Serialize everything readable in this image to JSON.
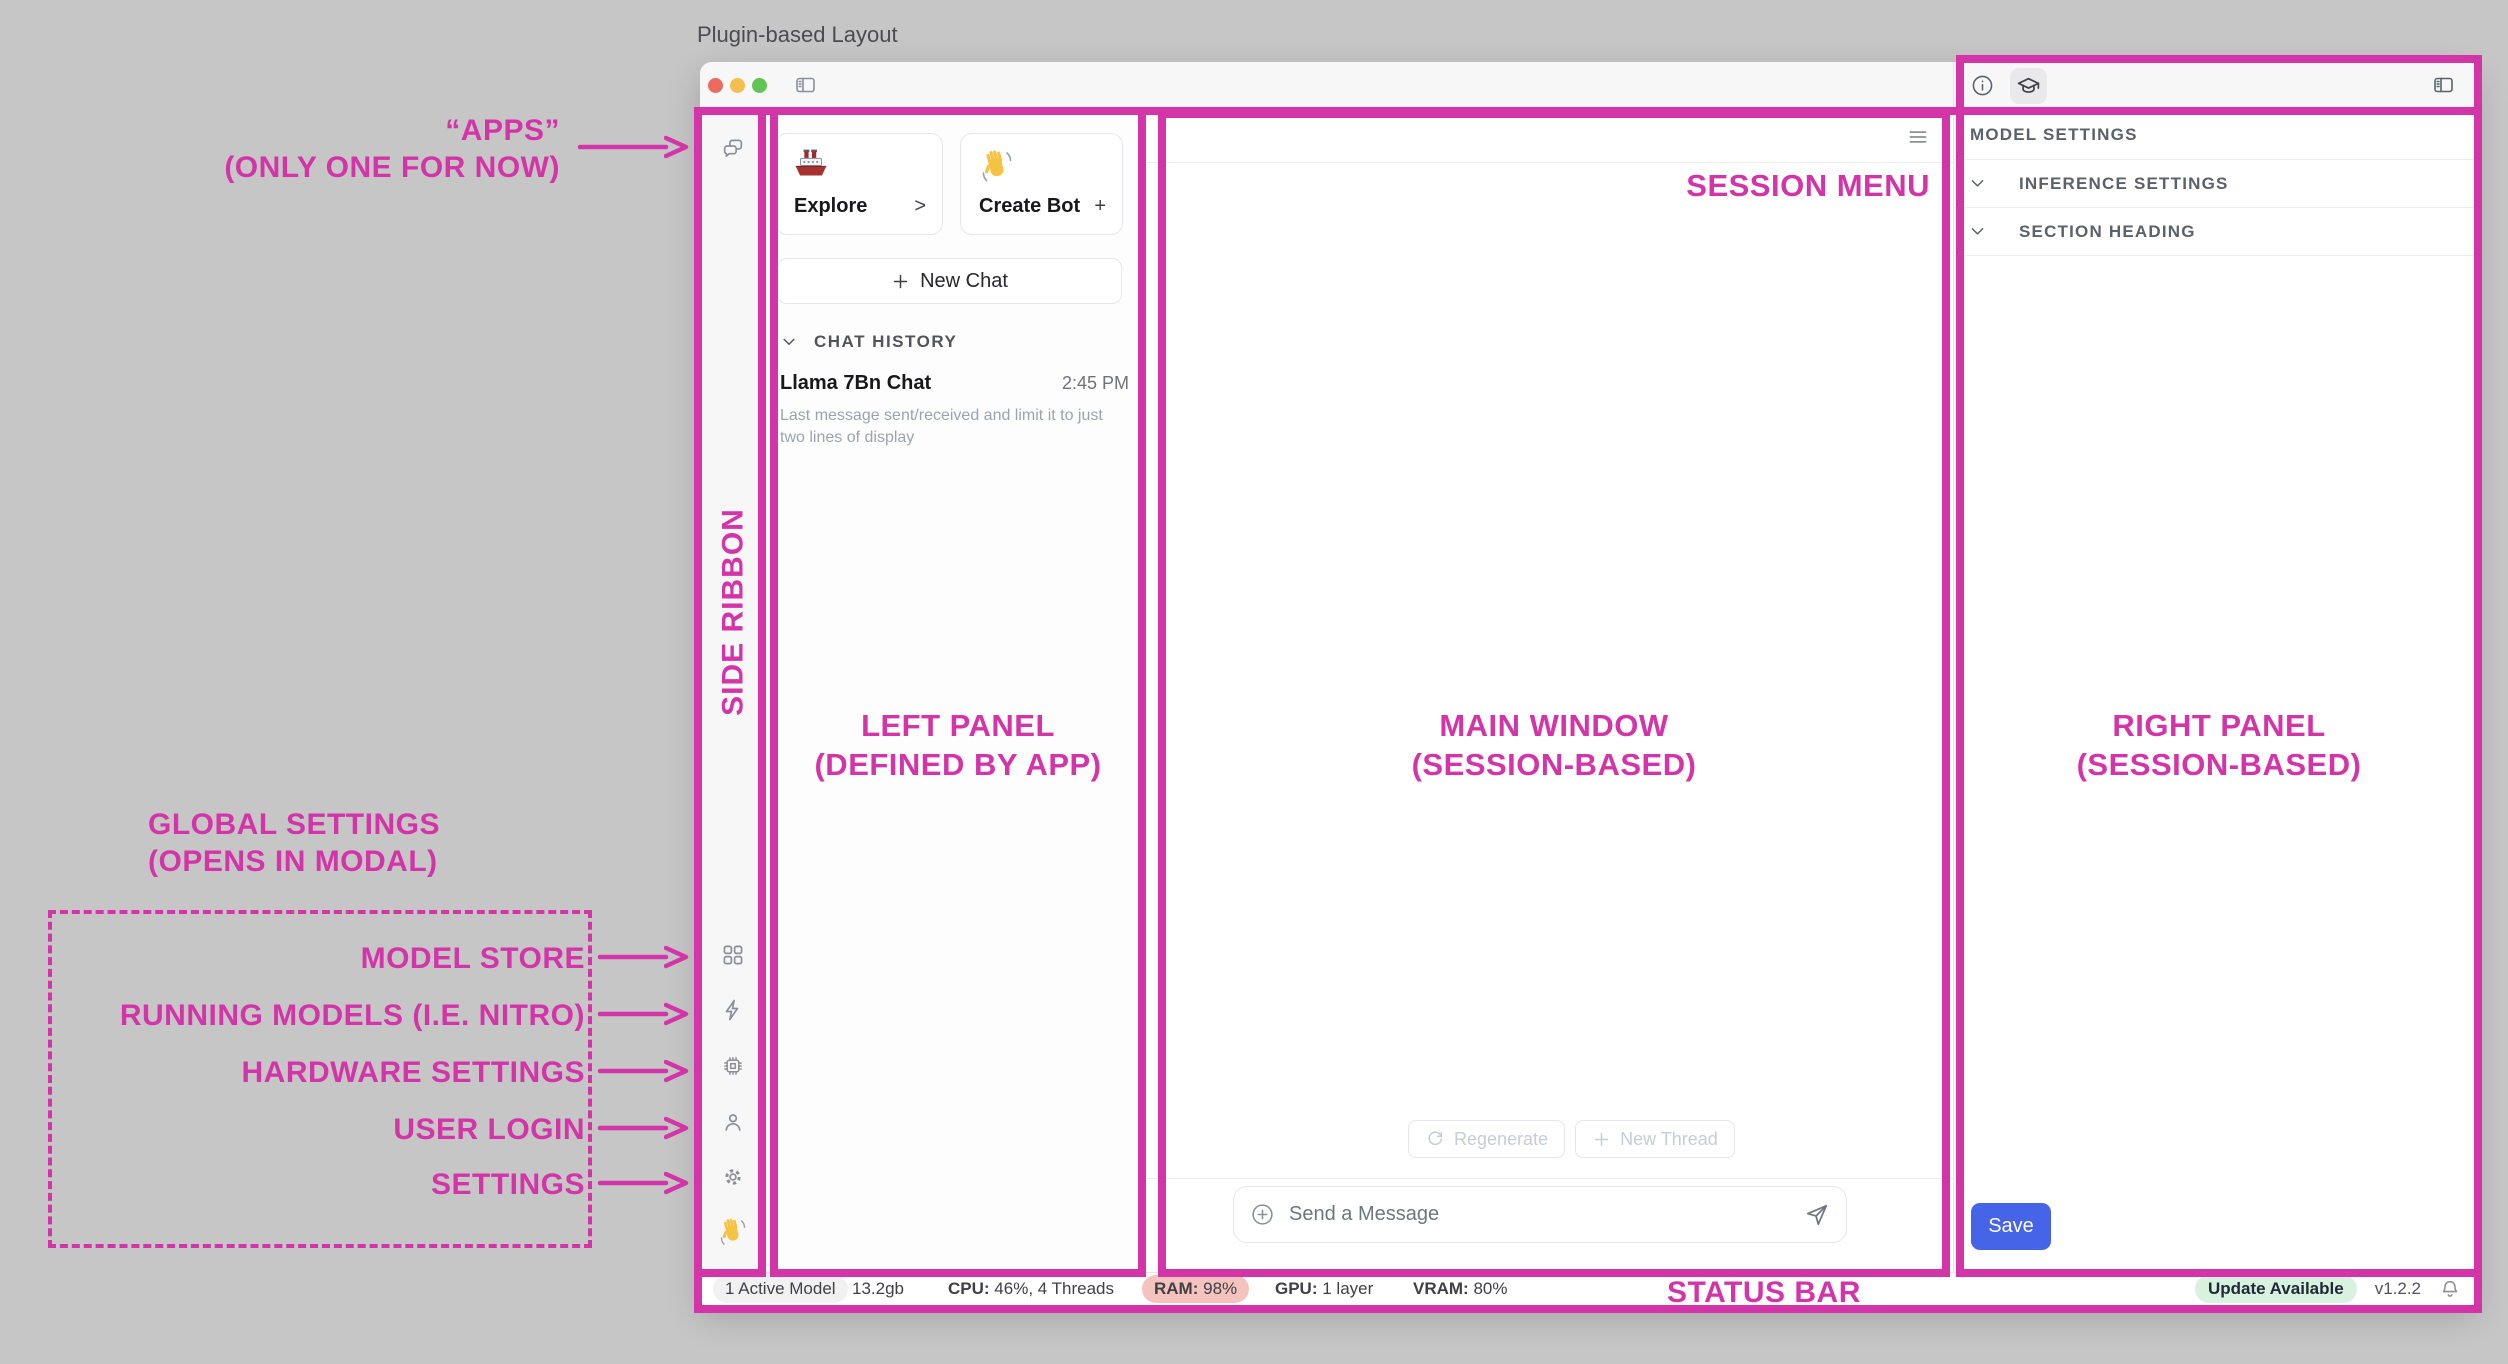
{
  "page": {
    "title": "Plugin-based Layout"
  },
  "annotations": {
    "apps_line1": "“APPS”",
    "apps_line2": "(ONLY ONE FOR NOW)",
    "global_settings_line1": "GLOBAL SETTINGS",
    "global_settings_line2": "(OPENS IN MODAL)",
    "modal_items": [
      "MODEL STORE",
      "RUNNING MODELS (I.E. NITRO)",
      "HARDWARE SETTINGS",
      "USER LOGIN",
      "SETTINGS"
    ],
    "side_ribbon": "SIDE RIBBON",
    "left_panel_line1": "LEFT PANEL",
    "left_panel_line2": "(DEFINED BY APP)",
    "main_window_line1": "MAIN WINDOW",
    "main_window_line2": "(SESSION-BASED)",
    "right_panel_line1": "RIGHT PANEL",
    "right_panel_line2": "(SESSION-BASED)",
    "session_menu": "SESSION MENU",
    "status_bar": "STATUS BAR"
  },
  "left_panel": {
    "cards": [
      {
        "icon": "ship-emoji",
        "label": "Explore",
        "action": ">"
      },
      {
        "icon": "wave-hand-emoji",
        "label": "Create Bot",
        "action": "+"
      }
    ],
    "new_chat_label": "New Chat",
    "chat_history_header": "CHAT HISTORY",
    "chat": {
      "title": "Llama 7Bn Chat",
      "time": "2:45 PM",
      "preview_line1": "Last message sent/received and limit it to just",
      "preview_line2": "two lines of display"
    }
  },
  "main": {
    "regenerate_label": "Regenerate",
    "new_thread_label": "New Thread",
    "composer_placeholder": "Send a Message"
  },
  "right_panel": {
    "model_settings_label": "MODEL SETTINGS",
    "rows": [
      "INFERENCE SETTINGS",
      "SECTION HEADING"
    ],
    "save_label": "Save"
  },
  "status_bar": {
    "active_model": "1 Active Model",
    "memory": "13.2gb",
    "cpu_label": "CPU:",
    "cpu_value": "46%, 4 Threads",
    "ram_label": "RAM:",
    "ram_value": "98%",
    "gpu_label": "GPU:",
    "gpu_value": "1 layer",
    "vram_label": "VRAM:",
    "vram_value": "80%",
    "update_badge": "Update Available",
    "version": "v1.2.2"
  },
  "colors": {
    "annotation_accent": "#D334A8",
    "save_button_blue": "#4564E8",
    "ram_badge": "#F5C3BE",
    "update_badge_green": "#D9F1DF"
  },
  "icons": [
    "close-icon",
    "minimize-icon",
    "zoom-icon",
    "sidebar-toggle-icon",
    "chat-bubbles-icon",
    "apps-grid-icon",
    "lightning-icon",
    "chip-icon",
    "user-icon",
    "gear-icon",
    "wave-hand-emoji",
    "ship-emoji",
    "hamburger-icon",
    "refresh-icon",
    "plus-icon",
    "circle-plus-icon",
    "send-icon",
    "info-icon",
    "graduation-cap-icon",
    "bell-icon",
    "chevron-down-icon"
  ]
}
